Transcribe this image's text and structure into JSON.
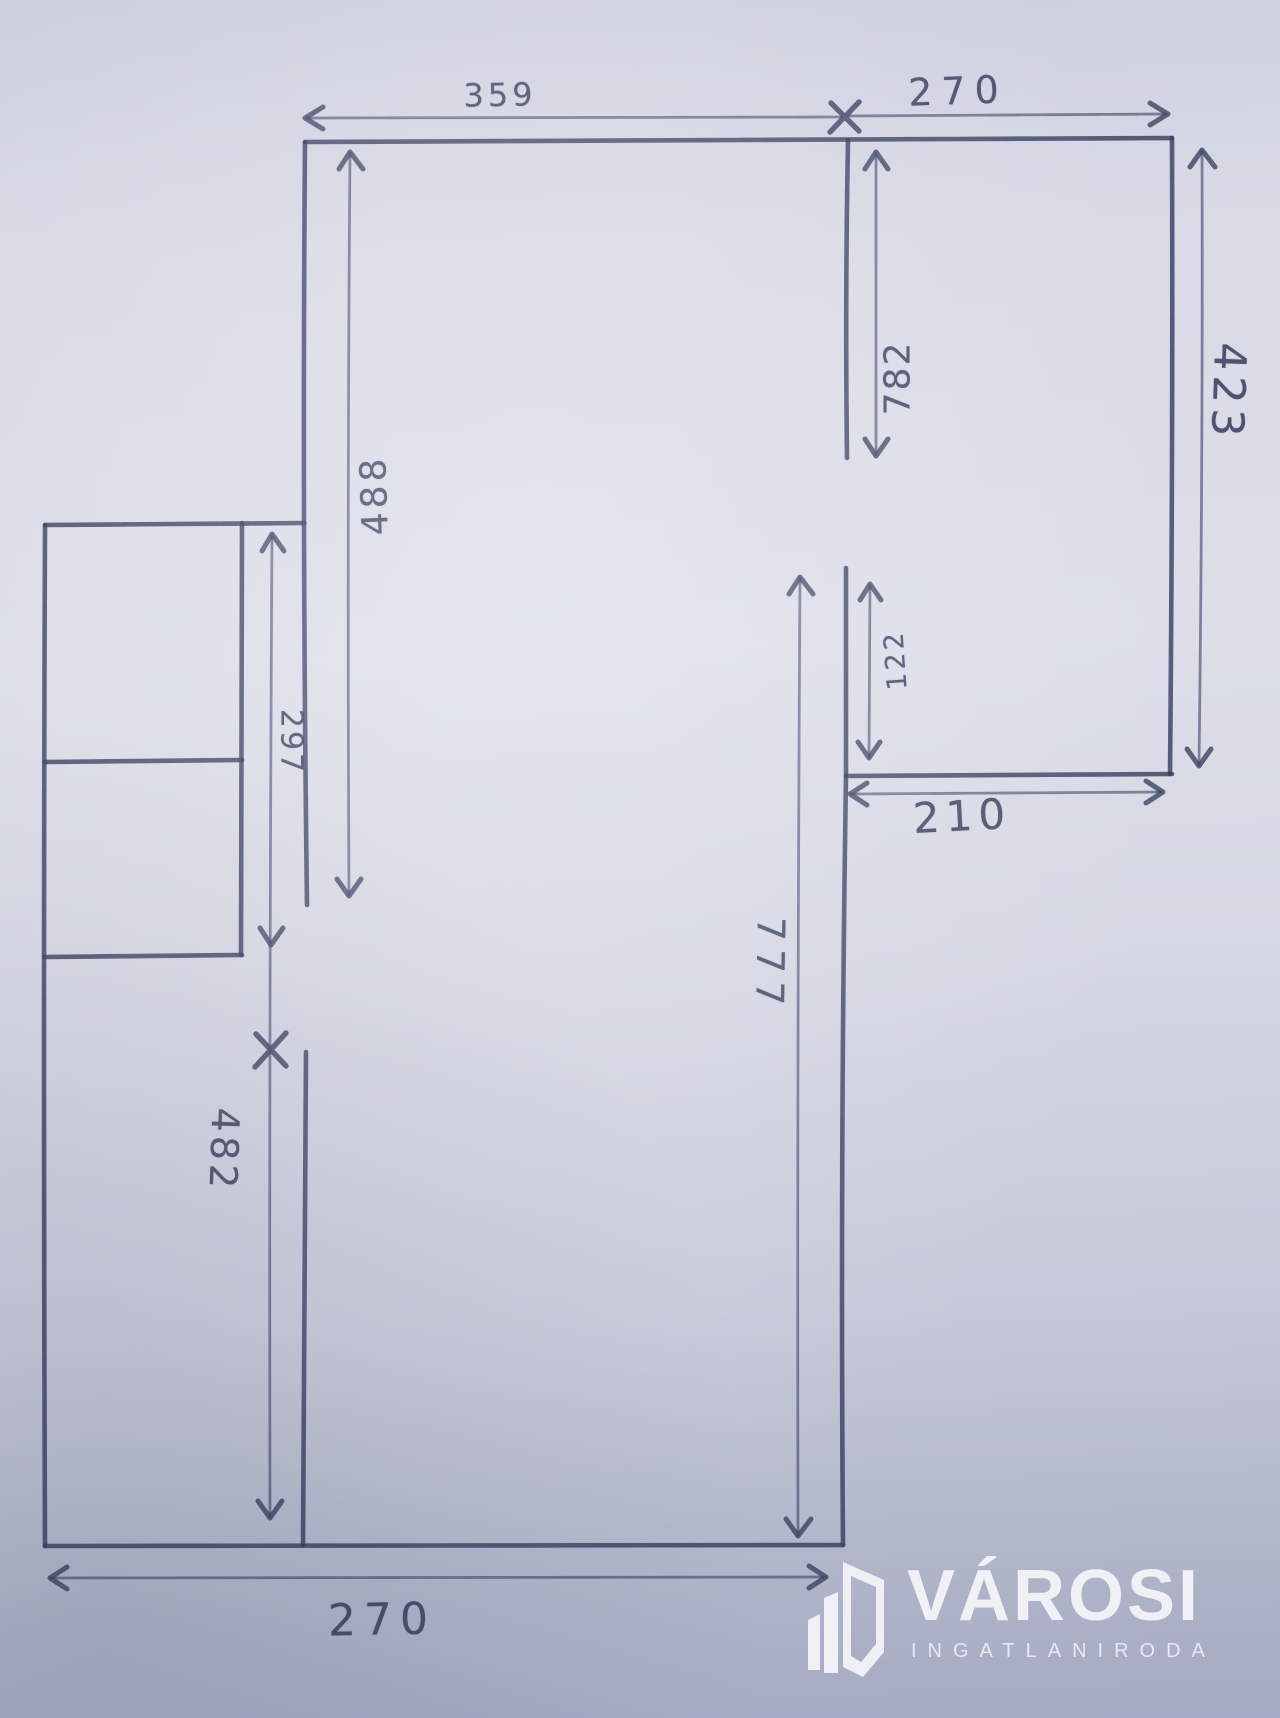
{
  "document": {
    "kind": "hand-drawn floor plan sketch",
    "paper_color": "#d8dae6",
    "ink_color": "#39405f"
  },
  "measurements": {
    "top_width_left": "359",
    "top_width_right": "270",
    "right_room_height": "423",
    "right_wall_upper_span": "782",
    "nook_height": "122",
    "nook_width": "210",
    "main_room_height": "777",
    "left_room_height": "488",
    "small_room_height": "297",
    "lower_left_height": "482",
    "bottom_width": "270"
  },
  "marks": {
    "x_mark_glyph": "×",
    "x_mark_top_note": "junction of 359 and 270 dimension lines",
    "x_mark_left_note": "boundary between 297 and 482 spans"
  },
  "watermark": {
    "title": "VÁROSI",
    "subtitle": "INGATLANIRODA",
    "color": "#f3f4f8"
  }
}
